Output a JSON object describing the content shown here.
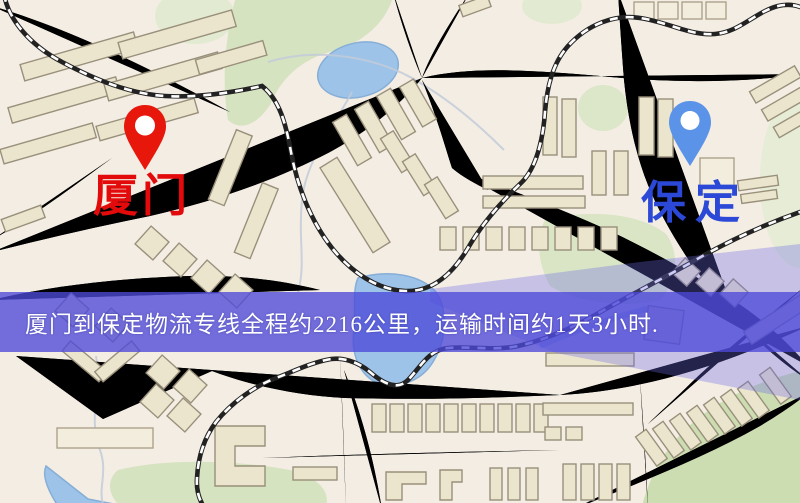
{
  "window": {
    "width": 800,
    "height": 503
  },
  "map": {
    "kind": "road-map",
    "markers": [
      {
        "id": "origin",
        "label": "厦门",
        "icon": "map-pin-icon",
        "pin_color": "#e8170c",
        "label_color": "#e20a0a"
      },
      {
        "id": "destination",
        "label": "保定",
        "icon": "map-pin-icon",
        "pin_color": "#5b93e8",
        "label_color": "#2b49d6"
      }
    ],
    "palette": {
      "land": "#f4ede4",
      "road_fill": "#f6d06f",
      "road_casing": "#e2a94f",
      "water": "#9dc3e9",
      "park": "#d6e3c1",
      "building": "#ece5cd",
      "building_outline": "#99907b",
      "railway": "#222222"
    }
  },
  "banner": {
    "text": "厦门到保定物流专线全程约2216公里，运输时间约1天3小时.",
    "background": "#4d49d8",
    "text_color": "#ffffff"
  }
}
